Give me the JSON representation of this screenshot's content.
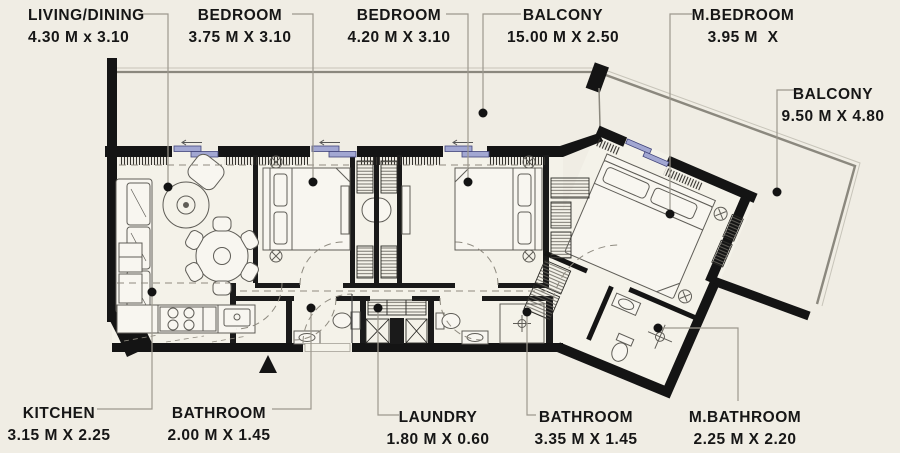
{
  "plan": {
    "type": "apartment-floor-plan",
    "units": "M",
    "colors": {
      "background": "#f0ede4",
      "walls": "#141414",
      "window_accent": "#a2a7d2",
      "leader_line": "#9c988e",
      "furniture_line": "#5f5d57"
    },
    "markers": {
      "north_arrow": "triangle-up",
      "leader_dot": "filled-circle"
    }
  },
  "rooms": [
    {
      "id": "living_dining",
      "label": "LIVING/DINING",
      "dimensions": "4.30 M x 3.10"
    },
    {
      "id": "bedroom_1",
      "label": "BEDROOM",
      "dimensions": "3.75 M X 3.10"
    },
    {
      "id": "bedroom_2",
      "label": "BEDROOM",
      "dimensions": "4.20 M X 3.10"
    },
    {
      "id": "balcony_top",
      "label": "BALCONY",
      "dimensions": "15.00 M X 2.50"
    },
    {
      "id": "master_bedroom",
      "label": "M.BEDROOM",
      "dimensions": "3.95 M  X"
    },
    {
      "id": "balcony_right",
      "label": "BALCONY",
      "dimensions": "9.50 M X 4.80"
    },
    {
      "id": "kitchen",
      "label": "KITCHEN",
      "dimensions": "3.15 M X 2.25"
    },
    {
      "id": "bathroom_1",
      "label": "BATHROOM",
      "dimensions": "2.00 M X 1.45"
    },
    {
      "id": "laundry",
      "label": "LAUNDRY",
      "dimensions": "1.80 M X 0.60"
    },
    {
      "id": "bathroom_2",
      "label": "BATHROOM",
      "dimensions": "3.35 M X 1.45"
    },
    {
      "id": "master_bathroom",
      "label": "M.BATHROOM",
      "dimensions": "2.25 M X 2.20"
    }
  ]
}
